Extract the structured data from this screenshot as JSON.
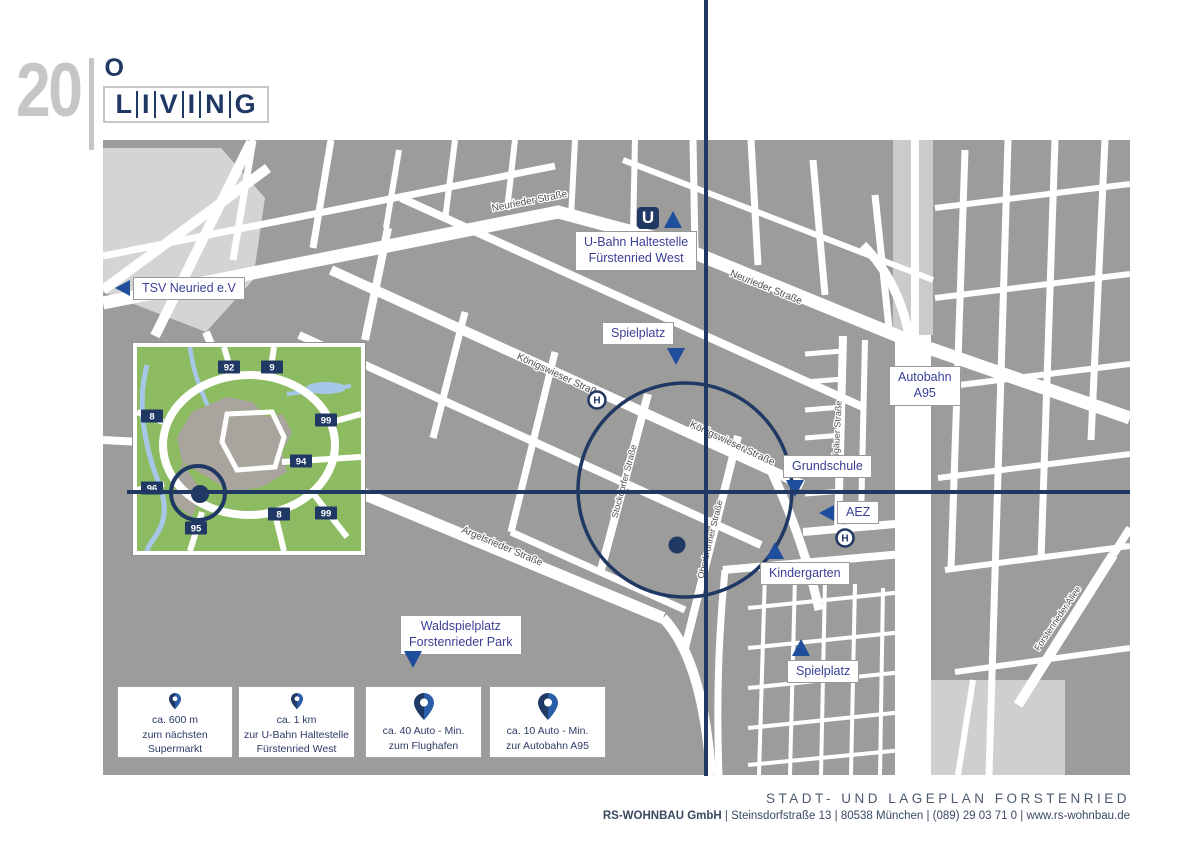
{
  "logo": {
    "number": "20",
    "o": "O",
    "letters": [
      "L",
      "I",
      "V",
      "I",
      "N",
      "G"
    ]
  },
  "map": {
    "streets": {
      "neurieder_w": "Neurieder Straße",
      "neurieder_e": "Neurieder Straße",
      "koenigswieser_1": "Königswieser Straße",
      "koenigswieser_2": "Königswieser Straße",
      "stockdorfer": "Stockdorfer Straße",
      "oberbrunner": "Oberbrunner Straße",
      "argelsrieder": "Argelsrieder Straße",
      "allgaeuer": "Allgäuer Straße",
      "forstenrieder": "Forstenrieder Allee"
    },
    "labels": {
      "tsv": "TSV Neuried e.V",
      "ubahn_line1": "U-Bahn Haltestelle",
      "ubahn_line2": "Fürstenried West",
      "spielplatz_top": "Spielplatz",
      "autobahn_line1": "Autobahn",
      "autobahn_line2": "A95",
      "grundschule": "Grundschule",
      "aez": "AEZ",
      "kindergarten": "Kindergarten",
      "waldspielplatz_line1": "Waldspielplatz",
      "waldspielplatz_line2": "Forstenrieder Park",
      "spielplatz_bottom": "Spielplatz"
    },
    "icons": {
      "ubahn": "U",
      "stop": "H"
    }
  },
  "inset": {
    "badges": [
      "92",
      "9",
      "8",
      "99",
      "94",
      "96",
      "8",
      "99",
      "95"
    ]
  },
  "distance_cards": [
    {
      "lines": [
        "ca. 600 m",
        "zum nächsten",
        "Supermarkt"
      ]
    },
    {
      "lines": [
        "ca. 1 km",
        "zur U-Bahn Haltestelle",
        "Fürstenried West"
      ]
    },
    {
      "lines": [
        "ca. 40 Auto - Min.",
        "zum Flughafen"
      ]
    },
    {
      "lines": [
        "ca. 10 Auto - Min.",
        "zur Autobahn A95"
      ]
    }
  ],
  "footer": {
    "title": "STADT- UND LAGEPLAN FORSTENRIED",
    "company": "RS-WOHNBAU GmbH",
    "address_rest": " | Steinsdorfstraße 13 | 80538 München | (089) 29 03 71 0 | www.rs-wohnbau.de"
  },
  "colors": {
    "navy": "#1f3864",
    "blue": "#1e4e9c",
    "label_text": "#3a3f96",
    "map_gray": "#9c9c9b",
    "light_gray": "#d4d4d4",
    "inset_green": "#8dbb62"
  }
}
